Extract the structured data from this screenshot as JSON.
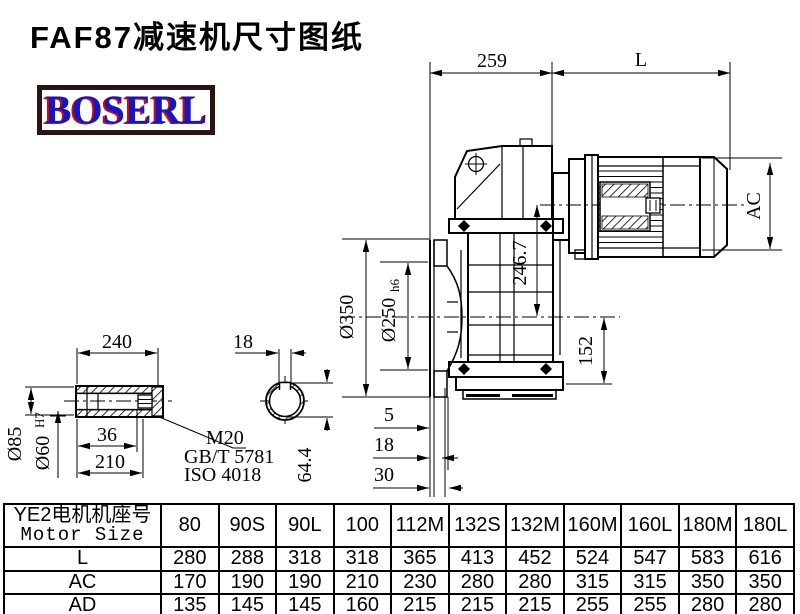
{
  "page": {
    "title": "FAF87减速机尺寸图纸"
  },
  "logo": {
    "text": "BOSERL",
    "text_color": "#1813c8",
    "shadow_color": "#c41200",
    "border_color": "#2a1512"
  },
  "drawing": {
    "labels": {
      "dim_259": "259",
      "dim_L": "L",
      "dim_AC": "AC",
      "dim_246_7": "246.7",
      "dim_d350": "Ø350",
      "dim_d250": "Ø250",
      "dim_d250_tol": "h6",
      "dim_152": "152",
      "dim_5": "5",
      "dim_18_flange": "18",
      "dim_30": "30",
      "dim_240": "240",
      "dim_18_key": "18",
      "dim_d85": "Ø85",
      "dim_d60": "Ø60",
      "dim_d60_tol": "H7",
      "dim_36": "36",
      "dim_210": "210",
      "bolt_spec": "M20",
      "bolt_std_gb": "GB/T 5781",
      "bolt_std_iso": "ISO 4018",
      "dim_64_4": "64.4"
    }
  },
  "table": {
    "header_cn": "YE2电机机座号",
    "header_en": "Motor Size",
    "columns": [
      "80",
      "90S",
      "90L",
      "100",
      "112M",
      "132S",
      "132M",
      "160M",
      "160L",
      "180M",
      "180L"
    ],
    "rows": [
      {
        "label": "L",
        "values": [
          "280",
          "288",
          "318",
          "318",
          "365",
          "413",
          "452",
          "524",
          "547",
          "583",
          "616"
        ]
      },
      {
        "label": "AC",
        "values": [
          "170",
          "190",
          "190",
          "210",
          "230",
          "280",
          "280",
          "315",
          "315",
          "350",
          "350"
        ]
      },
      {
        "label": "AD",
        "values": [
          "135",
          "145",
          "145",
          "160",
          "215",
          "215",
          "215",
          "255",
          "255",
          "280",
          "280"
        ]
      }
    ]
  }
}
